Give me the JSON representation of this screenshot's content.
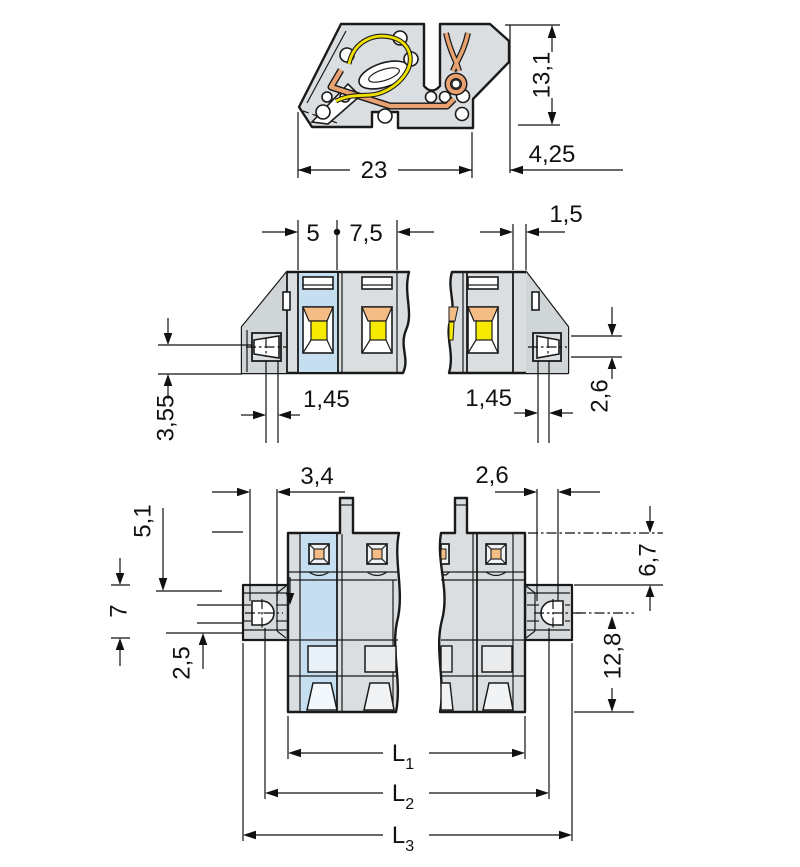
{
  "drawing_type": "connector dimensional drawing",
  "views": {
    "side": {
      "name": "side-cross-section",
      "labels": {
        "width": "23",
        "height": "13,1",
        "offset": "4,25"
      }
    },
    "front": {
      "name": "front-view",
      "labels": {
        "pole1": "5",
        "pitch": "7,5",
        "wall": "1,5",
        "hole_left": "1,45",
        "hole_right": "1,45",
        "hole_height": "2,6",
        "flange": "3,55"
      }
    },
    "bottom": {
      "name": "bottom-view",
      "labels": {
        "slot_left": "3,4",
        "slot_right": "2,6",
        "edge_to_flange_left": "5,1",
        "flange_height": "7",
        "hole_offset": "2,5",
        "edge_to_flange_right": "6,7",
        "flange_to_end": "12,8",
        "l1": {
          "base": "L",
          "sub": "1"
        },
        "l2": {
          "base": "L",
          "sub": "2"
        },
        "l3": {
          "base": "L",
          "sub": "3"
        }
      }
    }
  },
  "colors": {
    "background": "#ffffff",
    "line": "#1a1a1a",
    "body_gray": "#dbdee0",
    "shade_gray": "#d0d5d8",
    "highlight_blue": "#c5dff0",
    "contact_orange": "#f4bd85",
    "contact_yellow": "#f6ea00",
    "copper": "#e8a272",
    "spring_yellow": "#f0e000"
  }
}
